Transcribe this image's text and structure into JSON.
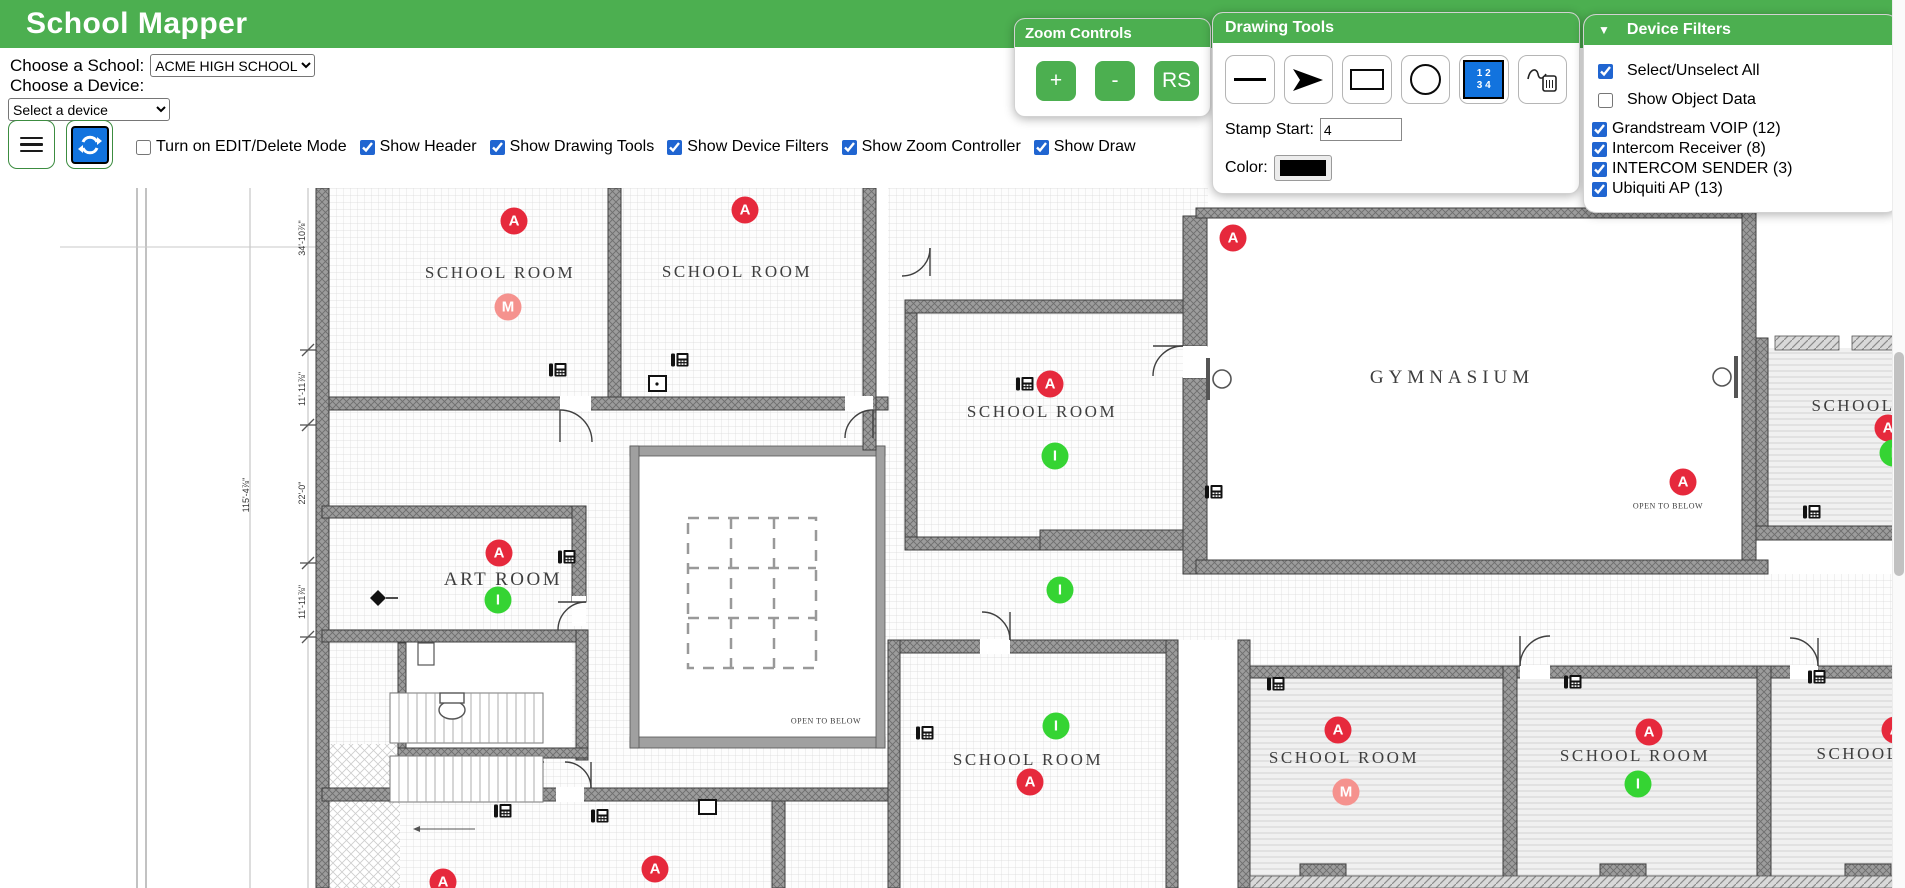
{
  "header": {
    "title": "School Mapper"
  },
  "school_select": {
    "label": "Choose a School:",
    "value": "ACME HIGH SCHOOL"
  },
  "device_select": {
    "label": "Choose a Device:",
    "value": "Select a device"
  },
  "toolbar": {
    "checkboxes": [
      {
        "label": "Turn on EDIT/Delete Mode",
        "checked": false
      },
      {
        "label": "Show Header",
        "checked": true
      },
      {
        "label": "Show Drawing Tools",
        "checked": true
      },
      {
        "label": "Show Device Filters",
        "checked": true
      },
      {
        "label": "Show Zoom Controller",
        "checked": true
      },
      {
        "label": "Show Draw",
        "checked": true
      }
    ]
  },
  "zoom_controls": {
    "title": "Zoom Controls",
    "buttons": [
      "+",
      "-",
      "RS"
    ]
  },
  "drawing_tools": {
    "title": "Drawing Tools",
    "tools": [
      "line",
      "arrow",
      "rectangle",
      "circle",
      "number-stamp",
      "erase-drawing"
    ],
    "stamp_start_label": "Stamp Start:",
    "stamp_start_value": "4",
    "color_label": "Color:",
    "color_value": "#000000"
  },
  "device_filters": {
    "title": "Device Filters",
    "collapse_icon": "▼",
    "items": [
      {
        "label": "Select/Unselect All",
        "checked": true
      },
      {
        "label": "Show Object Data",
        "checked": false
      },
      {
        "label": "Grandstream VOIP (12)",
        "checked": true
      },
      {
        "label": "Intercom Receiver (8)",
        "checked": true
      },
      {
        "label": "INTERCOM SENDER (3)",
        "checked": true
      },
      {
        "label": "Ubiquiti AP (13)",
        "checked": true
      }
    ]
  },
  "colors": {
    "brand_green": "#4caf50",
    "stamp_blue": "#1273de",
    "ap_red": "#e6293c",
    "receiver_green": "#35d433",
    "sender_pink": "#f5928e"
  },
  "map": {
    "legend": {
      "ubiquiti-ap": {
        "letter": "A",
        "color": "#e6293c"
      },
      "intercom-receiver": {
        "letter": "I",
        "color": "#35d433"
      },
      "intercom-sender": {
        "letter": "M",
        "color": "#f5928e"
      },
      "grandstream-voip": {
        "letter": "",
        "color": "#111111"
      }
    },
    "rooms": [
      {
        "label": "SCHOOL ROOM",
        "x": 500,
        "y": 273,
        "size": 17
      },
      {
        "label": "SCHOOL ROOM",
        "x": 737,
        "y": 272,
        "size": 17
      },
      {
        "label": "SCHOOL ROOM",
        "x": 1042,
        "y": 412,
        "size": 17
      },
      {
        "label": "GYMNASIUM",
        "x": 1452,
        "y": 378,
        "size": 19
      },
      {
        "label": "ART ROOM",
        "x": 503,
        "y": 580,
        "size": 19
      },
      {
        "label": "SCHOOL ROOM",
        "x": 1028,
        "y": 760,
        "size": 17
      },
      {
        "label": "SCHOOL ROOM",
        "x": 1344,
        "y": 758,
        "size": 17
      },
      {
        "label": "SCHOOL ROOM",
        "x": 1635,
        "y": 756,
        "size": 17
      },
      {
        "label": "SCHOOL",
        "x": 1858,
        "y": 754,
        "size": 17
      },
      {
        "label": "SCHOOL",
        "x": 1853,
        "y": 406,
        "size": 17
      },
      {
        "label": "OPEN TO BELOW",
        "x": 1668,
        "y": 506,
        "size": 8
      },
      {
        "label": "OPEN TO BELOW",
        "x": 826,
        "y": 721,
        "size": 8
      }
    ],
    "dimensions": [
      {
        "label": "34'-10⅞\"",
        "x": 302,
        "y": 238
      },
      {
        "label": "11'-11⅞\"",
        "x": 302,
        "y": 389
      },
      {
        "label": "22'-0\"",
        "x": 302,
        "y": 493
      },
      {
        "label": "11'-11⅞\"",
        "x": 302,
        "y": 602
      },
      {
        "label": "115'-4⅞\"",
        "x": 246,
        "y": 495
      }
    ],
    "devices": [
      {
        "type": "ubiquiti-ap",
        "x": 514,
        "y": 221
      },
      {
        "type": "ubiquiti-ap",
        "x": 745,
        "y": 210
      },
      {
        "type": "ubiquiti-ap",
        "x": 1233,
        "y": 238
      },
      {
        "type": "ubiquiti-ap",
        "x": 1050,
        "y": 384
      },
      {
        "type": "ubiquiti-ap",
        "x": 1888,
        "y": 428
      },
      {
        "type": "ubiquiti-ap",
        "x": 499,
        "y": 553
      },
      {
        "type": "ubiquiti-ap",
        "x": 1683,
        "y": 482
      },
      {
        "type": "ubiquiti-ap",
        "x": 1030,
        "y": 782
      },
      {
        "type": "ubiquiti-ap",
        "x": 1338,
        "y": 730
      },
      {
        "type": "ubiquiti-ap",
        "x": 1649,
        "y": 732
      },
      {
        "type": "ubiquiti-ap",
        "x": 1895,
        "y": 730
      },
      {
        "type": "ubiquiti-ap",
        "x": 443,
        "y": 882
      },
      {
        "type": "ubiquiti-ap",
        "x": 655,
        "y": 869
      },
      {
        "type": "intercom-sender",
        "x": 508,
        "y": 307
      },
      {
        "type": "intercom-sender",
        "x": 1346,
        "y": 792
      },
      {
        "type": "intercom-receiver",
        "x": 1055,
        "y": 456
      },
      {
        "type": "intercom-receiver",
        "x": 1893,
        "y": 453
      },
      {
        "type": "intercom-receiver",
        "x": 498,
        "y": 600
      },
      {
        "type": "intercom-receiver",
        "x": 1060,
        "y": 590
      },
      {
        "type": "intercom-receiver",
        "x": 1056,
        "y": 726
      },
      {
        "type": "intercom-receiver",
        "x": 1638,
        "y": 784
      },
      {
        "type": "grandstream-voip",
        "x": 558,
        "y": 370
      },
      {
        "type": "grandstream-voip",
        "x": 680,
        "y": 360
      },
      {
        "type": "grandstream-voip",
        "x": 1025,
        "y": 384
      },
      {
        "type": "grandstream-voip",
        "x": 1214,
        "y": 492
      },
      {
        "type": "grandstream-voip",
        "x": 567,
        "y": 557
      },
      {
        "type": "grandstream-voip",
        "x": 1812,
        "y": 512
      },
      {
        "type": "grandstream-voip",
        "x": 925,
        "y": 733
      },
      {
        "type": "grandstream-voip",
        "x": 1276,
        "y": 684
      },
      {
        "type": "grandstream-voip",
        "x": 1573,
        "y": 682
      },
      {
        "type": "grandstream-voip",
        "x": 1817,
        "y": 677
      },
      {
        "type": "grandstream-voip",
        "x": 503,
        "y": 811
      },
      {
        "type": "grandstream-voip",
        "x": 600,
        "y": 816
      }
    ]
  }
}
